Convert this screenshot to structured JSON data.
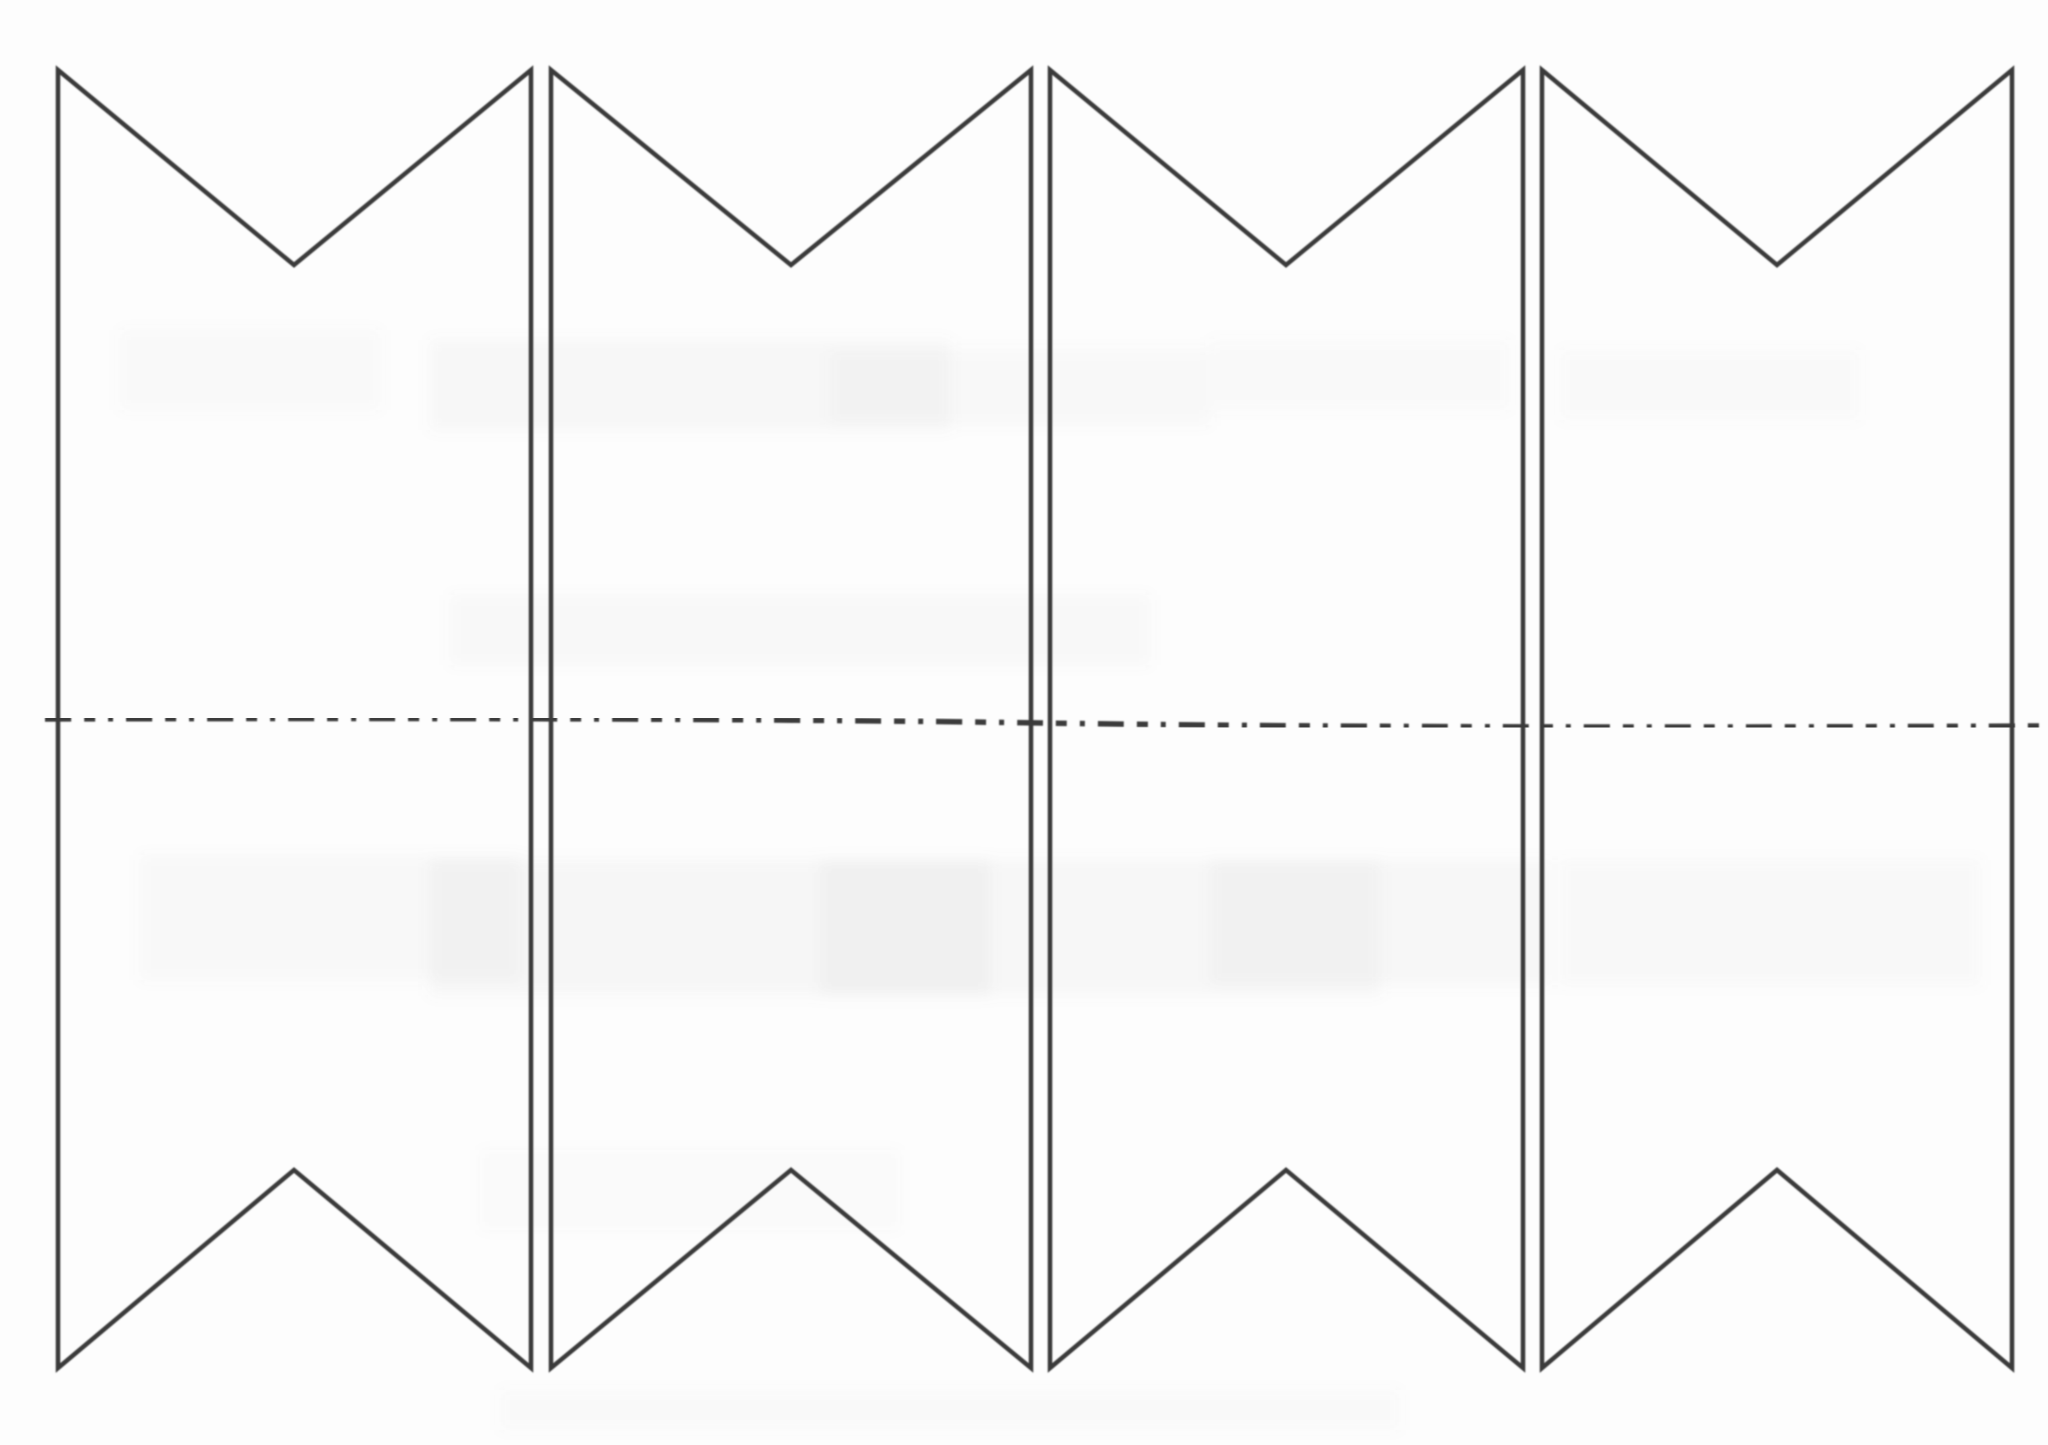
{
  "canvas": {
    "width": 2048,
    "height": 1445,
    "background": "#fdfdfd"
  },
  "style": {
    "stroke_color": "#3a3a3a",
    "stroke_width": 4.5,
    "fold_dash": "26 13 11 13 5 13",
    "smudge_color": "#8a8a8a"
  },
  "geometry": {
    "top_edge_y": 70,
    "top_notch_y": 265,
    "bottom_edge_y": 1368,
    "bottom_peak_y": 1170,
    "panels": [
      {
        "left": 58,
        "mid": 294,
        "right": 531
      },
      {
        "left": 551,
        "mid": 791,
        "right": 1031
      },
      {
        "left": 1050,
        "mid": 1286,
        "right": 1523
      },
      {
        "left": 1542,
        "mid": 1777,
        "right": 2012
      }
    ],
    "fold_line": {
      "x_start": 45,
      "x_end": 2040,
      "y_start": 719,
      "y_mid": 723,
      "y_end": 726
    }
  },
  "artifacts": {
    "smudges": [
      {
        "x": 120,
        "y": 330,
        "w": 260,
        "h": 80,
        "o": 0.035
      },
      {
        "x": 430,
        "y": 340,
        "w": 520,
        "h": 90,
        "o": 0.05
      },
      {
        "x": 830,
        "y": 350,
        "w": 380,
        "h": 75,
        "o": 0.04
      },
      {
        "x": 1210,
        "y": 340,
        "w": 300,
        "h": 70,
        "o": 0.03
      },
      {
        "x": 1560,
        "y": 350,
        "w": 300,
        "h": 70,
        "o": 0.03
      },
      {
        "x": 450,
        "y": 595,
        "w": 700,
        "h": 70,
        "o": 0.04
      },
      {
        "x": 140,
        "y": 855,
        "w": 380,
        "h": 125,
        "o": 0.04
      },
      {
        "x": 430,
        "y": 860,
        "w": 560,
        "h": 135,
        "o": 0.06
      },
      {
        "x": 820,
        "y": 860,
        "w": 560,
        "h": 135,
        "o": 0.05
      },
      {
        "x": 1210,
        "y": 860,
        "w": 340,
        "h": 125,
        "o": 0.05
      },
      {
        "x": 1560,
        "y": 860,
        "w": 420,
        "h": 125,
        "o": 0.045
      },
      {
        "x": 480,
        "y": 1150,
        "w": 420,
        "h": 80,
        "o": 0.025
      },
      {
        "x": 500,
        "y": 1390,
        "w": 900,
        "h": 40,
        "o": 0.03
      }
    ]
  }
}
